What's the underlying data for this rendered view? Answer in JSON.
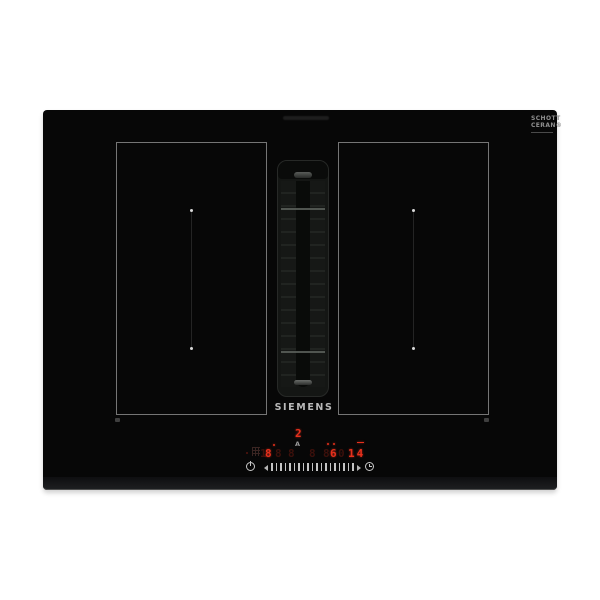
{
  "product": {
    "brand_logo": "SIEMENS",
    "glass_brand": {
      "line1": "SCHOTT",
      "line2": "CERAN®"
    }
  },
  "control_panel": {
    "hood_display": {
      "level": "2",
      "auto_indicator": "A"
    },
    "zone_displays": [
      {
        "text": "1",
        "state": "dim"
      },
      {
        "text": "8",
        "state": "bright"
      },
      {
        "text": "8",
        "state": "dim"
      },
      {
        "text": "8",
        "state": "dim"
      },
      {
        "text": "8",
        "state": "dim"
      },
      {
        "text": "8",
        "state": "dim"
      },
      {
        "text": "6",
        "state": "bright"
      },
      {
        "text": "0",
        "state": "dim"
      }
    ],
    "timer": {
      "value": "14"
    },
    "icons": [
      "power-icon",
      "slider-left-arrow-icon",
      "slider-right-arrow-icon",
      "timer-clock-icon",
      "cleaning-protection-icon"
    ],
    "colors": {
      "accent_red": "#e6301c",
      "dim_red": "#3c100b",
      "tick_gray": "#c4c4c4"
    }
  }
}
